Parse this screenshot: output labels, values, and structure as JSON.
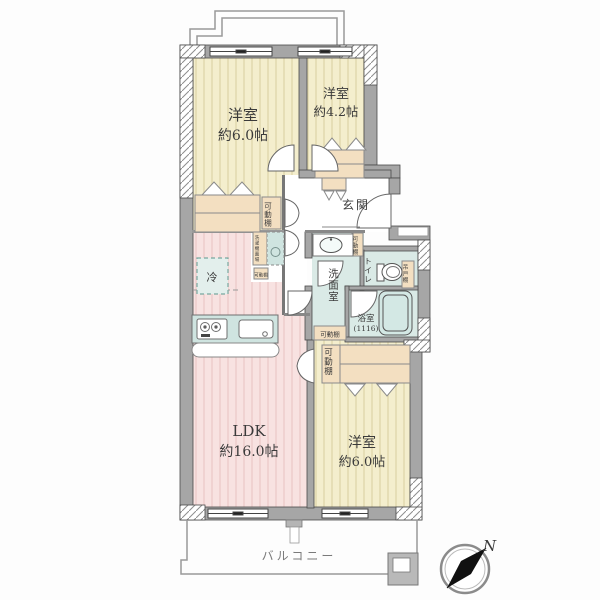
{
  "rooms": {
    "bedroom_top_left": {
      "label": "洋室",
      "size": "約6.0帖"
    },
    "bedroom_top_right": {
      "label": "洋室",
      "size": "約4.2帖"
    },
    "bedroom_right": {
      "label": "洋室",
      "size": "約6.0帖"
    },
    "ldk": {
      "label": "LDK",
      "size": "約16.0帖"
    },
    "entrance": {
      "label": "玄関"
    },
    "washroom": {
      "label": "洗面室"
    },
    "toilet": {
      "label": "トイレ"
    },
    "bathroom": {
      "label": "浴室",
      "size": "(1116)"
    },
    "balcony": {
      "label": "バルコニー"
    }
  },
  "fixtures": {
    "movable_shelf": {
      "label": "可動棚"
    },
    "refrigerator": {
      "label": "冷"
    },
    "washing_machine": {
      "label": "洗濯機置場"
    },
    "hanging_cupboard": {
      "label": "吊戸棚"
    }
  },
  "compass": {
    "north": "N"
  },
  "colors": {
    "wall": "#a6a6a6",
    "bedroom_floor": "#f4eecd",
    "ldk_floor": "#f8e2e1",
    "water_floor": "#daeae6",
    "furniture": "#f3dfc1",
    "counter": "#cfe4e0",
    "tub": "#d3e8e4",
    "accent_dash": "#79a8a0"
  }
}
